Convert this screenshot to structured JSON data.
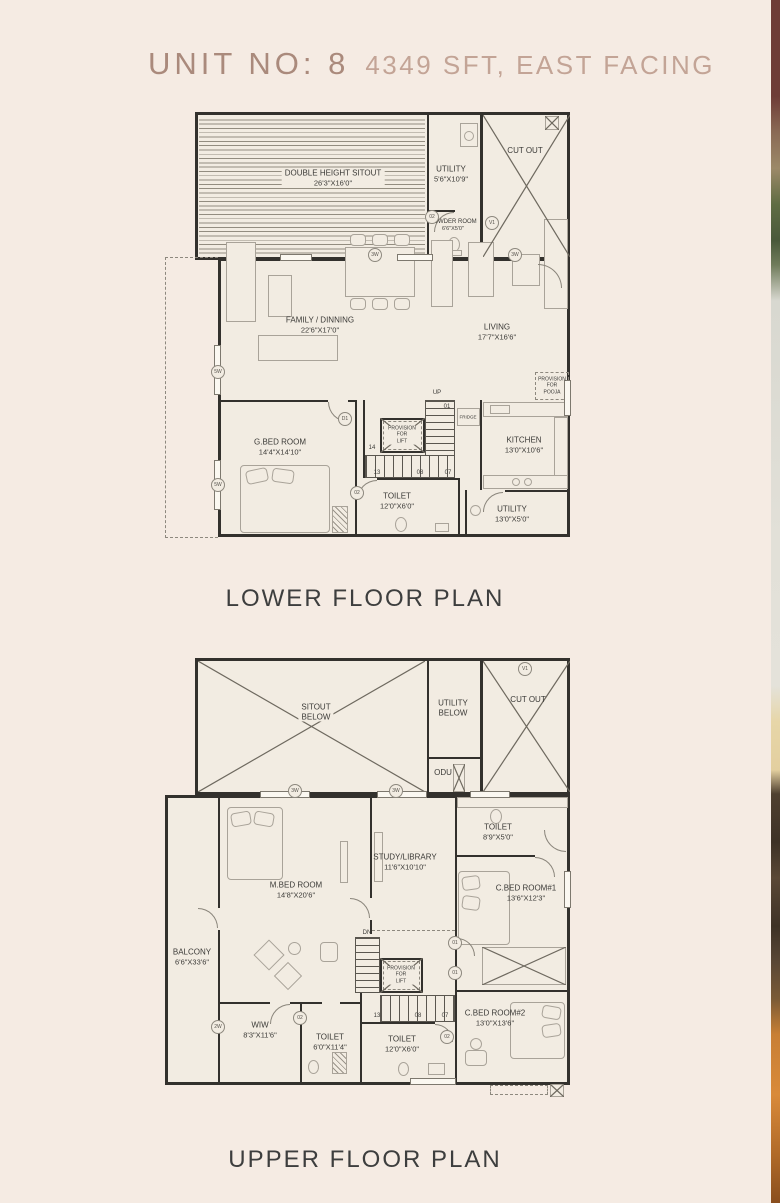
{
  "colors": {
    "background": "#f5ebe3",
    "title": "#aa8a7c",
    "subtitle": "#c3a496",
    "plan_line": "#33312d",
    "caption": "#3d3e3e"
  },
  "title": {
    "unit": "UNIT NO: 8",
    "details": "4349 SFT, EAST FACING"
  },
  "lower": {
    "caption": "LOWER FLOOR PLAN",
    "rooms": {
      "sitout": {
        "name": "DOUBLE HEIGHT SITOUT",
        "dim": "26'3\"X16'0\""
      },
      "utility": {
        "name": "UTILITY",
        "dim": "5'6\"X10'9\""
      },
      "powder": {
        "name": "POWDER ROOM",
        "dim": "6'6\"X5'0\""
      },
      "cutout": {
        "name": "CUT OUT"
      },
      "family": {
        "name": "FAMILY / DINNING",
        "dim": "22'6\"X17'0\""
      },
      "living": {
        "name": "LIVING",
        "dim": "17'7\"X16'6\""
      },
      "pooja": {
        "line1": "PROVISION",
        "line2": "FOR",
        "line3": "POOJA"
      },
      "gbed": {
        "name": "G.BED ROOM",
        "dim": "14'4\"X14'10\""
      },
      "lift": {
        "line1": "PROVISION",
        "line2": "FOR",
        "line3": "LIFT"
      },
      "fridge": {
        "name": "FRIDGE"
      },
      "kitchen": {
        "name": "KITCHEN",
        "dim": "13'0\"X10'6\""
      },
      "toilet": {
        "name": "TOILET",
        "dim": "12'0\"X6'0\""
      },
      "utility2": {
        "name": "UTILITY",
        "dim": "13'0\"X5'0\""
      }
    },
    "markers": {
      "up": "UP",
      "n01": "01",
      "n14": "14",
      "n13": "13",
      "n08": "08",
      "n07": "07",
      "d1": "D1",
      "d2": "02",
      "p02": "02",
      "v1": "V1",
      "w5a": "5W",
      "w5b": "5W",
      "w3a": "3W",
      "w3b": "3W"
    }
  },
  "upper": {
    "caption": "UPPER FLOOR PLAN",
    "rooms": {
      "sitout": {
        "line1": "SITOUT",
        "line2": "BELOW"
      },
      "utility": {
        "line1": "UTILITY",
        "line2": "BELOW"
      },
      "odu": {
        "name": "ODU"
      },
      "cutout": {
        "name": "CUT OUT"
      },
      "mbed": {
        "name": "M.BED ROOM",
        "dim": "14'8\"X20'6\""
      },
      "study": {
        "name": "STUDY/LIBRARY",
        "dim": "11'6\"X10'10\""
      },
      "toilet1": {
        "name": "TOILET",
        "dim": "8'9\"X5'0\""
      },
      "cbed1": {
        "name": "C.BED ROOM#1",
        "dim": "13'6\"X12'3\""
      },
      "balcony": {
        "name": "BALCONY",
        "dim": "6'6\"X33'6\""
      },
      "wiw": {
        "name": "WIW",
        "dim": "8'3\"X11'6\""
      },
      "toilet2": {
        "name": "TOILET",
        "dim": "6'0\"X11'4\""
      },
      "toilet3": {
        "name": "TOILET",
        "dim": "12'0\"X6'0\""
      },
      "lift": {
        "line1": "PROVISION",
        "line2": "FOR",
        "line3": "LIFT"
      },
      "cbed2": {
        "name": "C.BED ROOM#2",
        "dim": "13'0\"X13'6\""
      }
    },
    "markers": {
      "dn": "DN",
      "n13": "13",
      "n08": "08",
      "n07": "07",
      "d01a": "01",
      "d01b": "01",
      "d02a": "02",
      "d02b": "02",
      "v1": "V1",
      "w3a": "3W",
      "w3b": "3W",
      "w2": "2W"
    }
  }
}
